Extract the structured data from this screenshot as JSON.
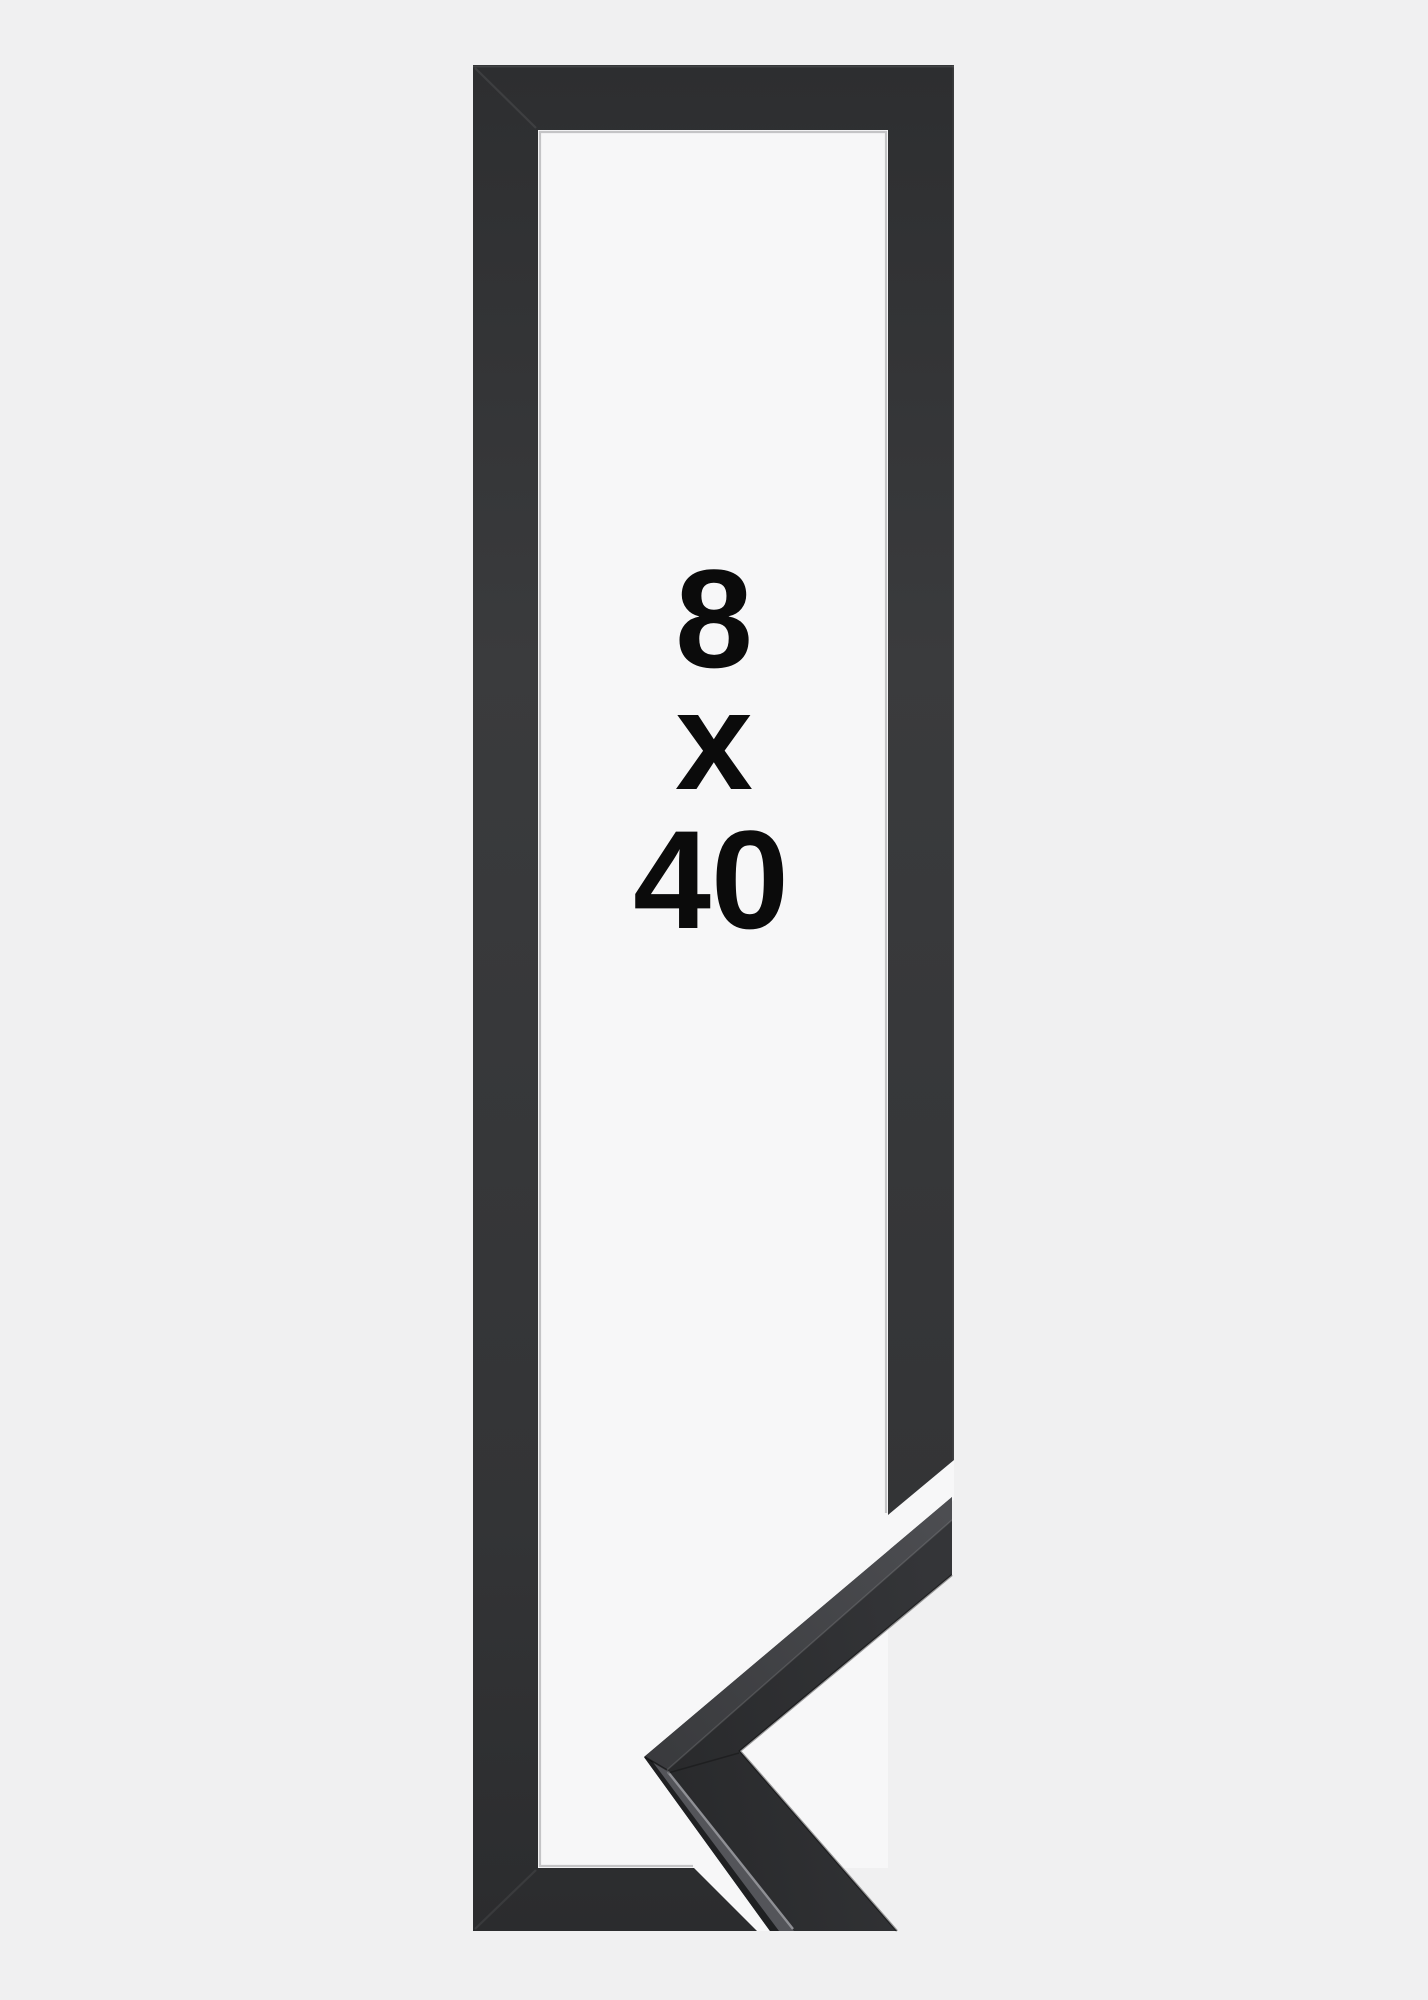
{
  "size_label": {
    "width": "8",
    "separator": "x",
    "height": "40"
  },
  "colors": {
    "background": "#f0f0f1",
    "interior": "#f7f7f8",
    "moulding_dark": "#2d2e30",
    "moulding_light": "#3a3b3d",
    "moulding_bottom": "#2b2c2e",
    "sample_face_dark": "#28292b",
    "sample_face_light": "#343538",
    "sample_top_lower": "#54555a",
    "sample_top_upper_dark": "#393a3d",
    "sample_top_upper_light": "#4c4d51",
    "lip_line": "#aeaeb0",
    "catch_light": "#94959a",
    "text": "#0b0b0b"
  }
}
